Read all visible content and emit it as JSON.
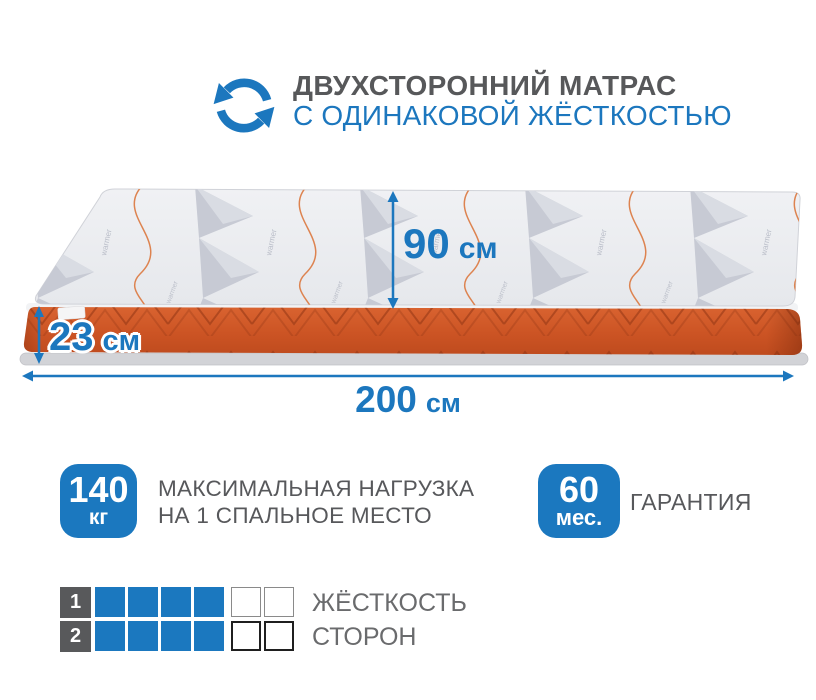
{
  "header": {
    "title": "ДВУХСТОРОННИЙ МАТРАС",
    "subtitle": "С ОДИНАКОВОЙ ЖЁСТКОСТЬЮ",
    "icon": "two-sided-rotation-icon"
  },
  "mattress_dimensions": {
    "width_depth": {
      "value": "90",
      "unit": "см"
    },
    "thickness": {
      "value": "23",
      "unit": "см"
    },
    "length": {
      "value": "200",
      "unit": "см"
    }
  },
  "features": {
    "max_load": {
      "value": "140",
      "unit": "кг",
      "label_line1": "МАКСИМАЛЬНАЯ НАГРУЗКА",
      "label_line2": "НА 1 СПАЛЬНОЕ МЕСТО"
    },
    "warranty": {
      "value": "60",
      "unit": "мес.",
      "label": "ГАРАНТИЯ"
    }
  },
  "hardness": {
    "label_line1": "ЖЁСТКОСТЬ",
    "label_line2": "СТОРОН",
    "rows": [
      {
        "side": "1",
        "filled": 4,
        "empty": 2
      },
      {
        "side": "2",
        "filled": 4,
        "empty": 2
      }
    ]
  },
  "colors": {
    "accent_blue": "#1b78bf",
    "mattress_orange": "#cc5627",
    "text_dark_gray": "#57585b",
    "text_mid_gray": "#6a6b6d"
  }
}
